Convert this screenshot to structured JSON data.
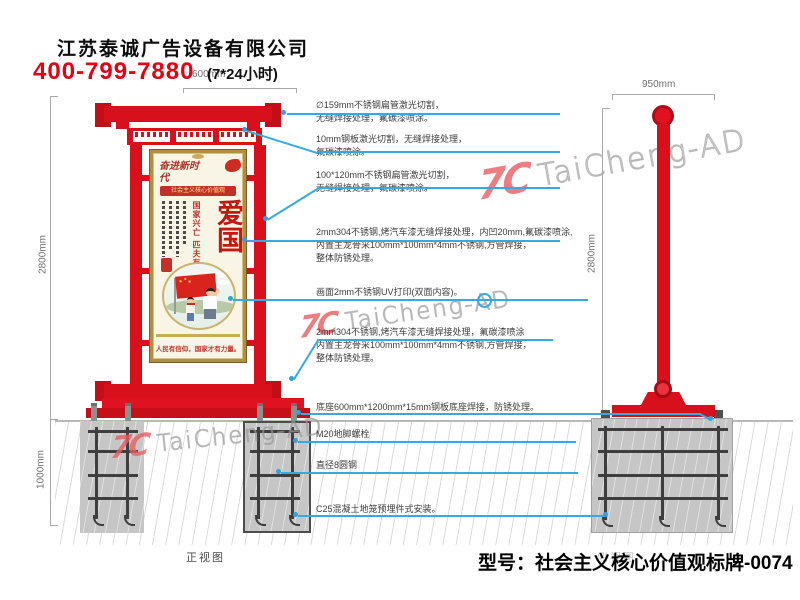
{
  "header": {
    "company": "江苏泰诚广告设备有限公司",
    "phone": "400-799-7880",
    "hours": "(7*24小时)"
  },
  "watermark": {
    "logo": "7C",
    "text": "TaiCheng-AD"
  },
  "views": {
    "front": {
      "label": "正视图"
    },
    "side": {
      "label": "侧视图"
    }
  },
  "dimensions": {
    "front_top_width": "600mm",
    "front_height": "2800mm",
    "foundation_depth": "1000mm",
    "side_width": "950mm",
    "side_height": "2800mm"
  },
  "poster": {
    "calligraphy": "奋进新时代",
    "banner": "社会主义核心价值观",
    "main_word": "爱国",
    "side_phrase": "国家兴亡 匹夫有责",
    "slogan": "人民有信仰，国家才有力量。"
  },
  "annotations": [
    {
      "lines": [
        "∅159mm不锈钢扁管激光切割，",
        "无缝焊接处理，氟碳漆喷涂。"
      ]
    },
    {
      "lines": [
        "10mm钢板激光切割，无缝焊接处理，",
        "氟碳漆喷涂。"
      ]
    },
    {
      "lines": [
        "100*120mm不锈钢扁管激光切割，",
        "无缝焊接处理，氟碳漆喷涂。"
      ]
    },
    {
      "lines": [
        "2mm304不锈钢,烤汽车漆无缝焊接处理，内凹20mm,氟碳漆喷涂,",
        "内置主龙骨采100mm*100mm*4mm不锈钢,方管焊接，",
        "整体防锈处理。"
      ]
    },
    {
      "lines": [
        "画面2mm不锈钢UV打印(双面内容)。"
      ]
    },
    {
      "lines": [
        "2mm304不锈钢,烤汽车漆无缝焊接处理，氟碳漆喷涂",
        "内置主龙骨采100mm*100mm*4mm不锈钢,方管焊接，",
        "整体防锈处理。"
      ]
    },
    {
      "lines": [
        "底座600mm*1200mm*15mm钢板底座焊接，防锈处理。"
      ]
    },
    {
      "lines": [
        "M20地脚螺栓"
      ]
    },
    {
      "lines": [
        "直径8圆钢"
      ]
    },
    {
      "lines": [
        "C25混凝土地笼预埋件式安装。"
      ]
    }
  ],
  "footer": {
    "model": "型号：社会主义核心价值观标牌-0074"
  },
  "colors": {
    "sign_red": "#d8101b",
    "leader_blue": "#35aae2",
    "phone_red": "#e60012",
    "gold": "#b08f3e"
  }
}
